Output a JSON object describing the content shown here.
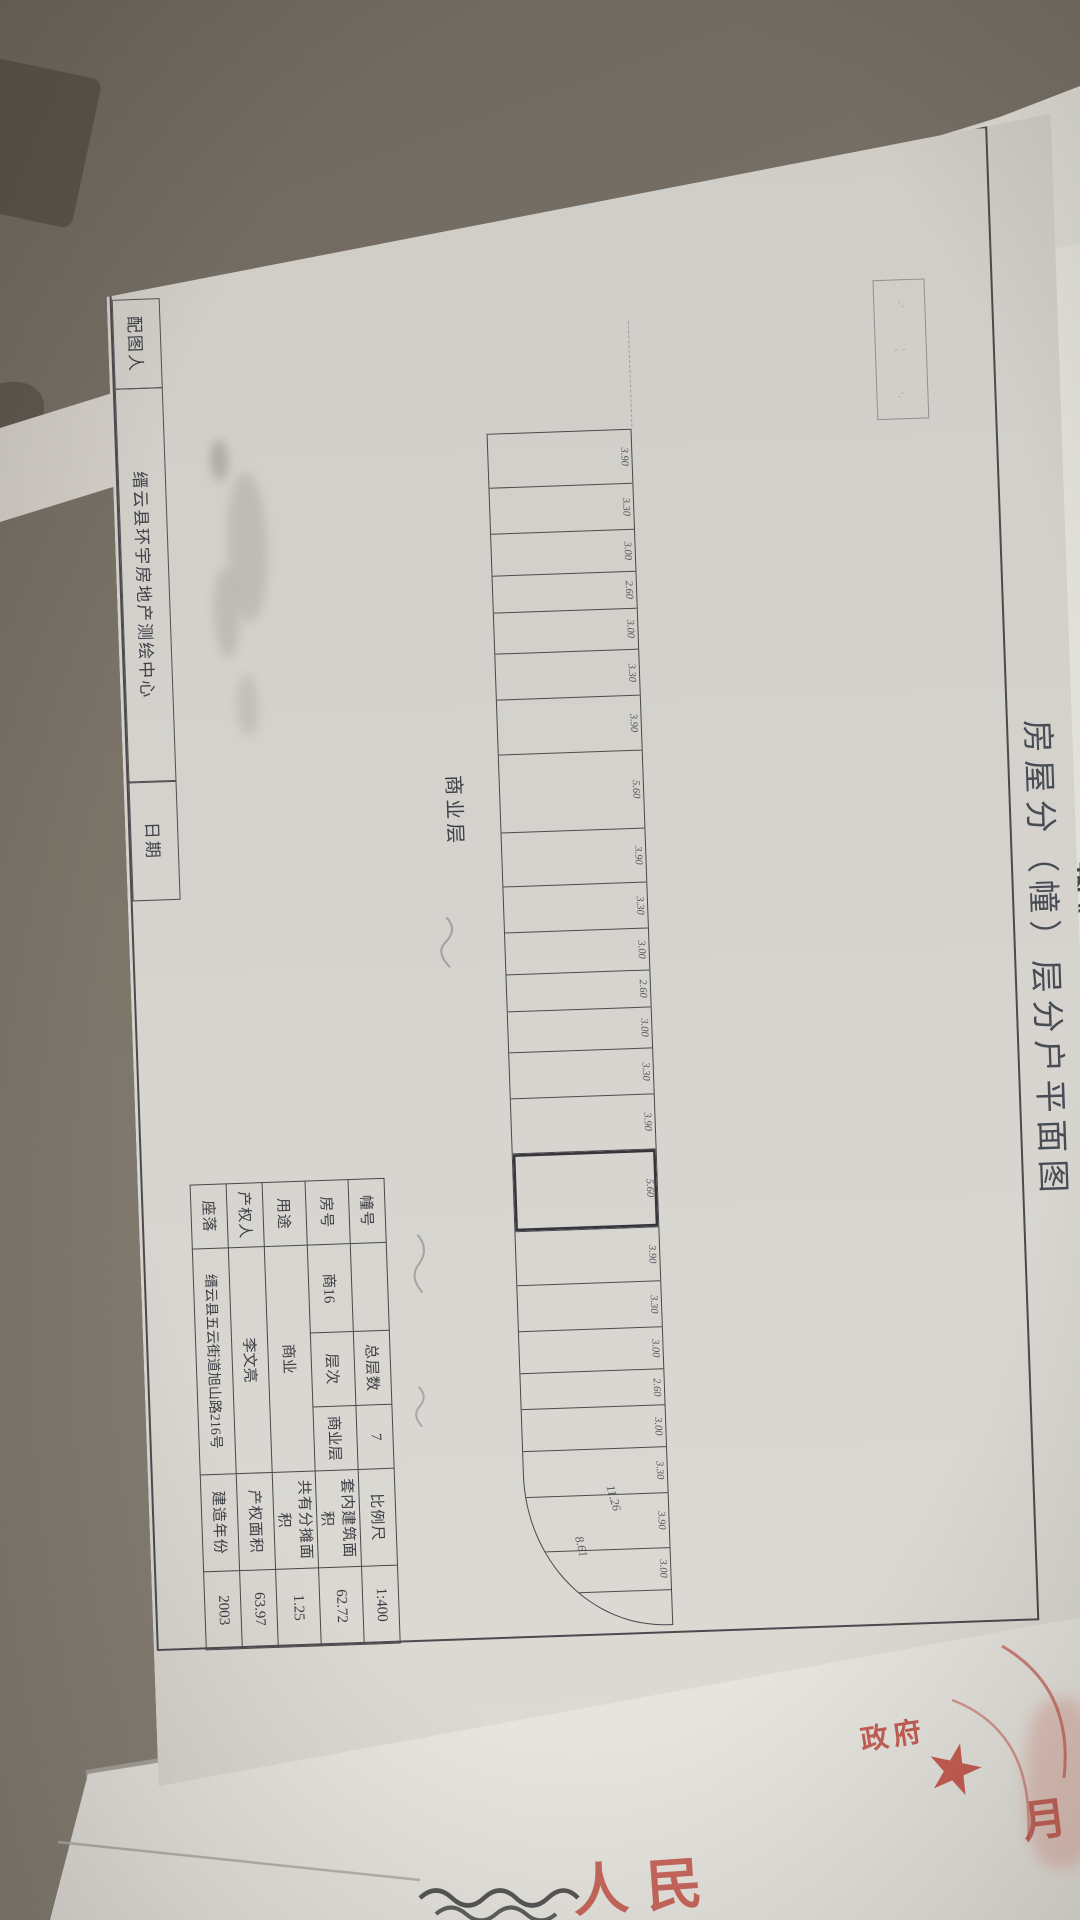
{
  "photo": {
    "surface_color": "#716a61",
    "paper_color": "#d7d4cf",
    "ink_color": "#45484e",
    "seal_red": "#b8433c"
  },
  "document": {
    "title": "房屋分（幢）层分户平面图",
    "footer_strip": {
      "maker_label": "配图人",
      "agency": "缙云县环宇房地产测绘中心",
      "date_label": "日期"
    },
    "floor_plan": {
      "floor_label": "商业层",
      "unit_widths": [
        "3.90",
        "3.30",
        "3.00",
        "2.60",
        "3.00",
        "3.30",
        "3.90",
        "5.60",
        "3.90",
        "3.30",
        "3.00",
        "2.60",
        "3.00",
        "3.30",
        "3.90",
        "5.60",
        "3.90",
        "3.30",
        "3.00",
        "2.60",
        "3.00",
        "3.30",
        "3.90",
        "3.00"
      ],
      "highlighted_unit_index": 15,
      "highlighted_unit_width": "5.60",
      "arc_dimensions": [
        "11.26",
        "8.61"
      ]
    },
    "info_table": {
      "rows": [
        {
          "cells": [
            {
              "label": "幢号",
              "value": ""
            },
            {
              "label": "总层数",
              "value": "7"
            },
            {
              "label": "比例尺",
              "value": "1:400"
            }
          ]
        },
        {
          "cells": [
            {
              "label": "房号",
              "value": "商16"
            },
            {
              "label": "层次",
              "value": "商业层"
            },
            {
              "label": "套内建筑面积",
              "value": "62.72"
            }
          ]
        },
        {
          "cells": [
            {
              "label": "用途",
              "value": "商业",
              "span": 3
            },
            {
              "label": "共有分摊面积",
              "value": "1.25"
            }
          ]
        },
        {
          "cells": [
            {
              "label": "产权人",
              "value": "李文亮",
              "span": 3
            },
            {
              "label": "产权面积",
              "value": "63.97"
            }
          ]
        },
        {
          "cells": [
            {
              "label": "座落",
              "value": "缙云县五云街道旭山路216号",
              "span": 3
            },
            {
              "label": "建造年份",
              "value": "2003"
            }
          ]
        }
      ]
    }
  },
  "background_document": {
    "legal_fragments": [
      "法》、《中华人民共",
      "律法规，为",
      "对土地使",
      "权利，维"
    ],
    "seals": {
      "large_text": "人民",
      "small_text": "政府",
      "month_text": "月",
      "star_icon": "★"
    }
  }
}
